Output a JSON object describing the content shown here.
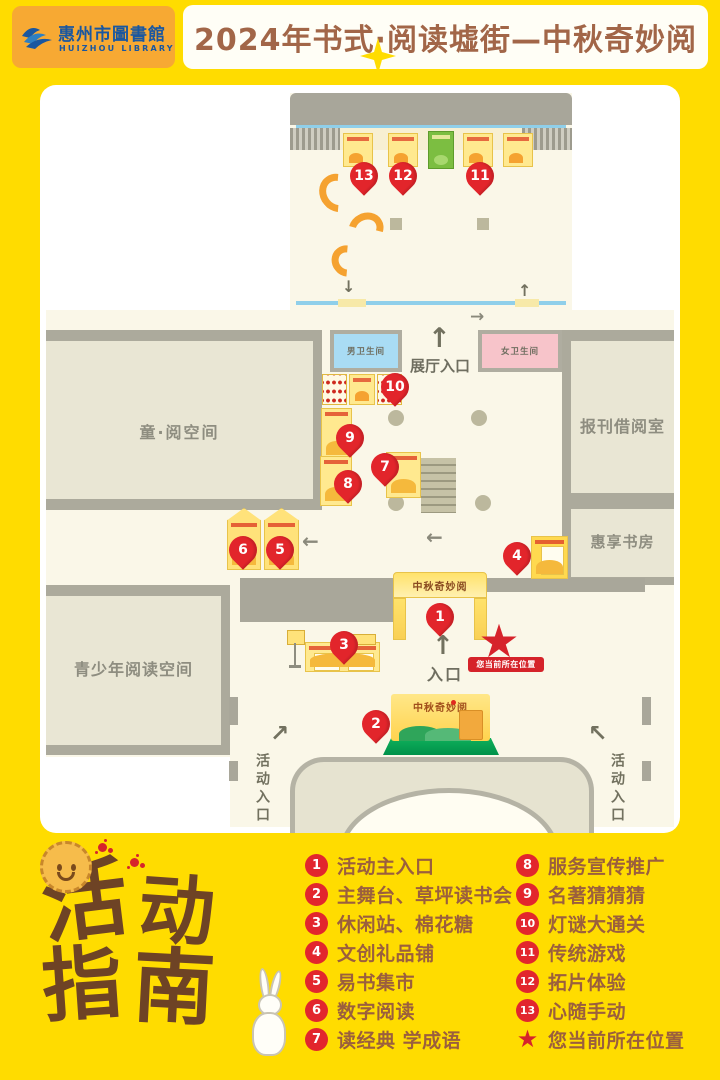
{
  "header": {
    "library_name_cn": "惠州市圖書館",
    "library_name_en": "HUIZHOU LIBRARY",
    "event_title": "2024年书式·阅读墟街—中秋奇妙阅"
  },
  "map": {
    "rooms": {
      "children_reading": "童·阅空间",
      "newspaper_reading": "报刊借阅室",
      "study_room": "惠享书房",
      "youth_reading": "青少年阅读空间",
      "mens_restroom": "男卫生间",
      "womens_restroom": "女卫生间"
    },
    "labels": {
      "exhibition_entrance": "展厅入口",
      "main_entrance": "入口",
      "activity_entrance": "活动入口",
      "current_location": "您当前所在位置",
      "arch_banner": "中秋奇妙阅",
      "stage_banner": "中秋奇妙阅"
    },
    "arrows": {
      "up": "↑",
      "down": "↓",
      "left": "←",
      "right": "→",
      "up_right": "↗",
      "up_left": "↖"
    },
    "star": "★",
    "pins": [
      "1",
      "2",
      "3",
      "4",
      "5",
      "6",
      "7",
      "8",
      "9",
      "10",
      "11",
      "12",
      "13"
    ]
  },
  "legend": {
    "title": [
      "活",
      "动",
      "指",
      "南"
    ],
    "column1": [
      {
        "num": "1",
        "label": "活动主入口"
      },
      {
        "num": "2",
        "label": "主舞台、草坪读书会"
      },
      {
        "num": "3",
        "label": "休闲站、棉花糖"
      },
      {
        "num": "4",
        "label": "文创礼品铺"
      },
      {
        "num": "5",
        "label": "易书集市"
      },
      {
        "num": "6",
        "label": "数字阅读"
      },
      {
        "num": "7",
        "label": "读经典 学成语"
      }
    ],
    "column2": [
      {
        "num": "8",
        "label": "服务宣传推广"
      },
      {
        "num": "9",
        "label": "名著猜猜猜"
      },
      {
        "num": "10",
        "label": "灯谜大通关"
      },
      {
        "num": "11",
        "label": "传统游戏"
      },
      {
        "num": "12",
        "label": "拓片体验"
      },
      {
        "num": "13",
        "label": "心随手动"
      },
      {
        "num": "★",
        "label": "您当前所在位置"
      }
    ]
  },
  "colors": {
    "page_yellow": "#FFDC00",
    "header_orange": "#F7A933",
    "logo_blue": "#1A57A0",
    "title_brown": "#A26648",
    "pin_red": "#E2252B",
    "legend_brown": "#9B5F3D",
    "stage_green": "#00A14F",
    "restroom_blue": "#A9DCF4",
    "restroom_pink": "#F7C4CA"
  }
}
